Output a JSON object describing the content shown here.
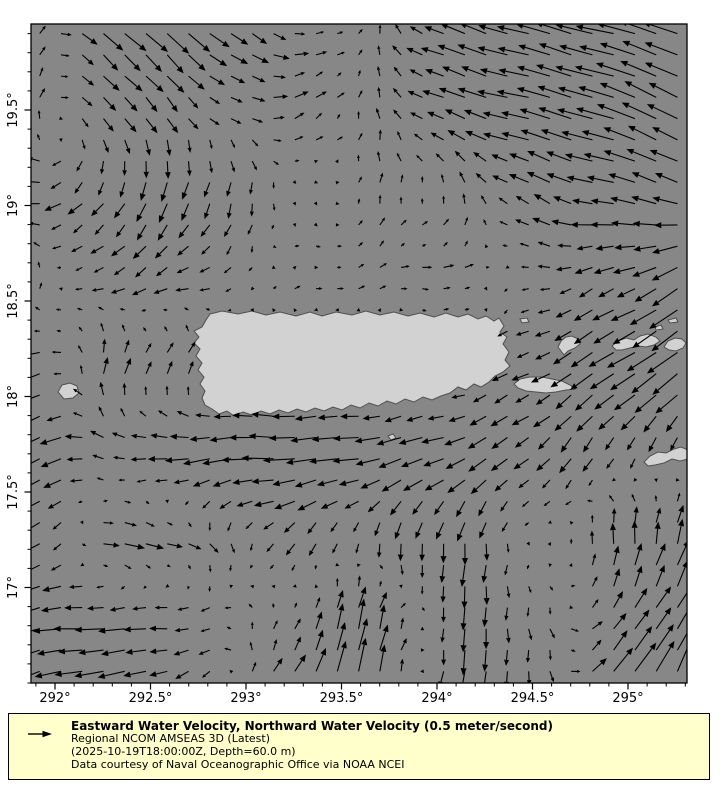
{
  "figure": {
    "width": 720,
    "height": 800,
    "background": "#ffffff"
  },
  "map": {
    "plot_rect_px": {
      "left": 31,
      "top": 24,
      "right": 687,
      "bottom": 683
    },
    "projection": {
      "lon_ref": 292,
      "ref_x_px": 55,
      "lat_ref": 19.5,
      "ref_y_px": 110,
      "px_per_degree": 191
    },
    "extent": {
      "lon_min": 291.874,
      "lon_max": 295.308,
      "lat_min": 16.5,
      "lat_max": 19.95
    },
    "colors": {
      "sea": "#878787",
      "land": "#d2d2d2",
      "coastline": "#4f4f4f",
      "arrows": "#000000",
      "axes": "#000000",
      "tick_labels": "#000000"
    },
    "x_axis": {
      "major_ticks": [
        {
          "value": 292,
          "label": "292°"
        },
        {
          "value": 292.5,
          "label": "292.5°"
        },
        {
          "value": 293,
          "label": "293°"
        },
        {
          "value": 293.5,
          "label": "293.5°"
        },
        {
          "value": 294,
          "label": "294°"
        },
        {
          "value": 294.5,
          "label": "294.5°"
        },
        {
          "value": 295,
          "label": "295°"
        }
      ],
      "minor_step": 0.1
    },
    "y_axis": {
      "major_ticks": [
        {
          "value": 17,
          "label": "17°"
        },
        {
          "value": 17.5,
          "label": "17.5°"
        },
        {
          "value": 18,
          "label": "18°"
        },
        {
          "value": 18.5,
          "label": "18.5°"
        },
        {
          "value": 19,
          "label": "19°"
        },
        {
          "value": 19.5,
          "label": "19.5°"
        }
      ],
      "minor_step": 0.1
    },
    "islands": [
      {
        "name": "puerto-rico",
        "px": [
          [
            210,
            314
          ],
          [
            222,
            311
          ],
          [
            238,
            314
          ],
          [
            252,
            311
          ],
          [
            266,
            315
          ],
          [
            280,
            312
          ],
          [
            296,
            316
          ],
          [
            310,
            312
          ],
          [
            322,
            316
          ],
          [
            336,
            312
          ],
          [
            352,
            315
          ],
          [
            366,
            311
          ],
          [
            380,
            315
          ],
          [
            394,
            312
          ],
          [
            408,
            316
          ],
          [
            420,
            313
          ],
          [
            434,
            317
          ],
          [
            446,
            313
          ],
          [
            458,
            317
          ],
          [
            468,
            314
          ],
          [
            478,
            319
          ],
          [
            486,
            316
          ],
          [
            494,
            321
          ],
          [
            499,
            318
          ],
          [
            504,
            326
          ],
          [
            500,
            332
          ],
          [
            507,
            337
          ],
          [
            503,
            344
          ],
          [
            509,
            352
          ],
          [
            505,
            360
          ],
          [
            510,
            366
          ],
          [
            503,
            372
          ],
          [
            495,
            376
          ],
          [
            489,
            382
          ],
          [
            481,
            387
          ],
          [
            474,
            384
          ],
          [
            466,
            390
          ],
          [
            458,
            387
          ],
          [
            450,
            393
          ],
          [
            441,
            396
          ],
          [
            432,
            400
          ],
          [
            423,
            397
          ],
          [
            414,
            402
          ],
          [
            405,
            399
          ],
          [
            396,
            404
          ],
          [
            387,
            401
          ],
          [
            378,
            406
          ],
          [
            369,
            403
          ],
          [
            360,
            408
          ],
          [
            351,
            405
          ],
          [
            342,
            410
          ],
          [
            333,
            407
          ],
          [
            324,
            411
          ],
          [
            315,
            408
          ],
          [
            306,
            412
          ],
          [
            297,
            409
          ],
          [
            288,
            413
          ],
          [
            279,
            410
          ],
          [
            270,
            414
          ],
          [
            261,
            411
          ],
          [
            252,
            415
          ],
          [
            243,
            412
          ],
          [
            234,
            416
          ],
          [
            227,
            411
          ],
          [
            219,
            414
          ],
          [
            212,
            409
          ],
          [
            205,
            405
          ],
          [
            202,
            398
          ],
          [
            205,
            391
          ],
          [
            200,
            384
          ],
          [
            204,
            377
          ],
          [
            198,
            370
          ],
          [
            202,
            363
          ],
          [
            196,
            356
          ],
          [
            200,
            349
          ],
          [
            194,
            343
          ],
          [
            199,
            337
          ],
          [
            194,
            331
          ],
          [
            202,
            327
          ],
          [
            206,
            320
          ]
        ]
      },
      {
        "name": "mona",
        "px": [
          [
            58,
            392
          ],
          [
            62,
            385
          ],
          [
            70,
            383
          ],
          [
            77,
            386
          ],
          [
            79,
            393
          ],
          [
            73,
            398
          ],
          [
            64,
            399
          ]
        ]
      },
      {
        "name": "vieques",
        "px": [
          [
            514,
            384
          ],
          [
            520,
            379
          ],
          [
            530,
            377
          ],
          [
            542,
            377
          ],
          [
            552,
            379
          ],
          [
            562,
            381
          ],
          [
            570,
            385
          ],
          [
            575,
            389
          ],
          [
            566,
            390
          ],
          [
            556,
            392
          ],
          [
            546,
            393
          ],
          [
            536,
            392
          ],
          [
            526,
            391
          ],
          [
            518,
            388
          ]
        ]
      },
      {
        "name": "culebra",
        "px": [
          [
            558,
            347
          ],
          [
            561,
            341
          ],
          [
            566,
            337
          ],
          [
            572,
            336
          ],
          [
            578,
            339
          ],
          [
            580,
            344
          ],
          [
            575,
            348
          ],
          [
            568,
            351
          ],
          [
            564,
            355
          ],
          [
            561,
            351
          ]
        ]
      },
      {
        "name": "st-thomas",
        "px": [
          [
            612,
            346
          ],
          [
            618,
            341
          ],
          [
            626,
            338
          ],
          [
            634,
            340
          ],
          [
            640,
            336
          ],
          [
            648,
            334
          ],
          [
            656,
            337
          ],
          [
            660,
            341
          ],
          [
            654,
            345
          ],
          [
            646,
            347
          ],
          [
            638,
            346
          ],
          [
            630,
            348
          ],
          [
            622,
            350
          ],
          [
            616,
            350
          ]
        ]
      },
      {
        "name": "st-john-tortola",
        "px": [
          [
            664,
            347
          ],
          [
            668,
            341
          ],
          [
            675,
            338
          ],
          [
            682,
            339
          ],
          [
            686,
            343
          ],
          [
            683,
            348
          ],
          [
            676,
            351
          ],
          [
            669,
            350
          ]
        ]
      },
      {
        "name": "cay-east-1",
        "px": [
          [
            668,
            320
          ],
          [
            676,
            318
          ],
          [
            678,
            322
          ],
          [
            670,
            323
          ]
        ]
      },
      {
        "name": "cay-east-2",
        "px": [
          [
            655,
            327
          ],
          [
            661,
            325
          ],
          [
            663,
            329
          ],
          [
            656,
            330
          ]
        ]
      },
      {
        "name": "cay-north",
        "px": [
          [
            520,
            319
          ],
          [
            527,
            318
          ],
          [
            529,
            322
          ],
          [
            522,
            323
          ]
        ]
      },
      {
        "name": "caja-de-muertos",
        "px": [
          [
            388,
            436
          ],
          [
            393,
            434
          ],
          [
            396,
            438
          ],
          [
            391,
            440
          ]
        ]
      },
      {
        "name": "st-croix",
        "px": [
          [
            644,
            462
          ],
          [
            650,
            456
          ],
          [
            658,
            452
          ],
          [
            666,
            453
          ],
          [
            674,
            449
          ],
          [
            681,
            447
          ],
          [
            688,
            450
          ],
          [
            688,
            459
          ],
          [
            680,
            461
          ],
          [
            672,
            459
          ],
          [
            664,
            463
          ],
          [
            655,
            465
          ],
          [
            648,
            466
          ]
        ]
      }
    ]
  },
  "chart_data": {
    "type": "quiver",
    "title": "",
    "xlabel": "",
    "ylabel": "",
    "x_range": [
      291.874,
      295.308
    ],
    "y_range": [
      16.5,
      19.95
    ],
    "units": "meter/second",
    "reference": {
      "value": 0.5,
      "label": "0.5 meter/second",
      "key_arrow_px": 22
    },
    "vector_field": {
      "note": "u eastward, v northward (m/s); coarse control grid read from the plot, bilinearly interpolated onto the 31x31 arrow grid",
      "grid_lons": [
        291.87,
        292.3,
        292.75,
        293.2,
        293.65,
        294.1,
        294.55,
        295.0,
        295.31
      ],
      "grid_lats": [
        19.95,
        19.5,
        19.05,
        18.6,
        18.15,
        17.7,
        17.25,
        16.8,
        16.5
      ],
      "u": [
        [
          0.05,
          0.22,
          0.25,
          0.15,
          0.03,
          -0.28,
          -0.35,
          -0.4,
          -0.38
        ],
        [
          0.02,
          0.15,
          0.1,
          0.15,
          0.0,
          -0.25,
          -0.35,
          -0.42,
          -0.3
        ],
        [
          -0.22,
          -0.1,
          -0.08,
          0.0,
          0.02,
          0.0,
          -0.2,
          -0.28,
          -0.25
        ],
        [
          0.05,
          -0.15,
          -0.15,
          0.05,
          0.08,
          0.12,
          -0.1,
          -0.2,
          -0.3
        ],
        [
          -0.2,
          0.08,
          0.1,
          -0.1,
          -0.1,
          -0.1,
          -0.18,
          -0.3,
          -0.32
        ],
        [
          -0.3,
          -0.15,
          -0.3,
          -0.35,
          -0.3,
          -0.25,
          -0.15,
          -0.05,
          0.0
        ],
        [
          -0.25,
          0.25,
          0.12,
          -0.1,
          0.0,
          -0.02,
          0.0,
          0.0,
          0.08
        ],
        [
          -0.28,
          -0.3,
          -0.15,
          0.05,
          0.08,
          -0.02,
          0.02,
          0.15,
          0.2
        ],
        [
          -0.25,
          -0.3,
          -0.12,
          0.12,
          0.08,
          -0.05,
          0.0,
          0.25,
          0.15
        ]
      ],
      "v": [
        [
          0.1,
          -0.22,
          -0.2,
          -0.05,
          0.08,
          0.1,
          0.1,
          0.1,
          0.12
        ],
        [
          0.12,
          -0.18,
          -0.1,
          0.05,
          0.1,
          0.08,
          0.08,
          0.15,
          0.18
        ],
        [
          0.0,
          -0.18,
          -0.22,
          -0.08,
          0.08,
          0.1,
          0.1,
          0.05,
          0.12
        ],
        [
          0.1,
          -0.08,
          -0.05,
          0.02,
          0.02,
          0.0,
          -0.02,
          -0.1,
          -0.18
        ],
        [
          -0.08,
          0.2,
          0.12,
          0.0,
          0.0,
          0.0,
          -0.1,
          -0.2,
          -0.22
        ],
        [
          -0.15,
          0.05,
          -0.05,
          0.0,
          -0.05,
          -0.1,
          -0.15,
          -0.15,
          -0.1
        ],
        [
          -0.1,
          -0.02,
          -0.08,
          -0.12,
          -0.15,
          -0.25,
          0.0,
          0.25,
          0.28
        ],
        [
          -0.05,
          0.0,
          -0.02,
          0.1,
          0.35,
          -0.25,
          -0.12,
          0.2,
          0.3
        ],
        [
          -0.1,
          -0.05,
          -0.1,
          0.2,
          0.4,
          -0.3,
          -0.15,
          0.35,
          0.4
        ]
      ],
      "arrow_grid": {
        "cols": 31,
        "rows": 31,
        "lon_start": 291.92,
        "lat_start": 19.9,
        "step": 0.1113
      },
      "scale_px_per_unit": 92
    }
  },
  "legend": {
    "title": "Eastward Water Velocity, Northward Water Velocity (0.5 meter/second)",
    "model": "Regional NCOM AMSEAS 3D (Latest)",
    "timestamp": "(2025-10-19T18:00:00Z, Depth=60.0 m)",
    "credit": "Data courtesy of Naval Oceanographic Office via NOAA NCEI",
    "background": "#ffffcc",
    "border": "#000000"
  }
}
